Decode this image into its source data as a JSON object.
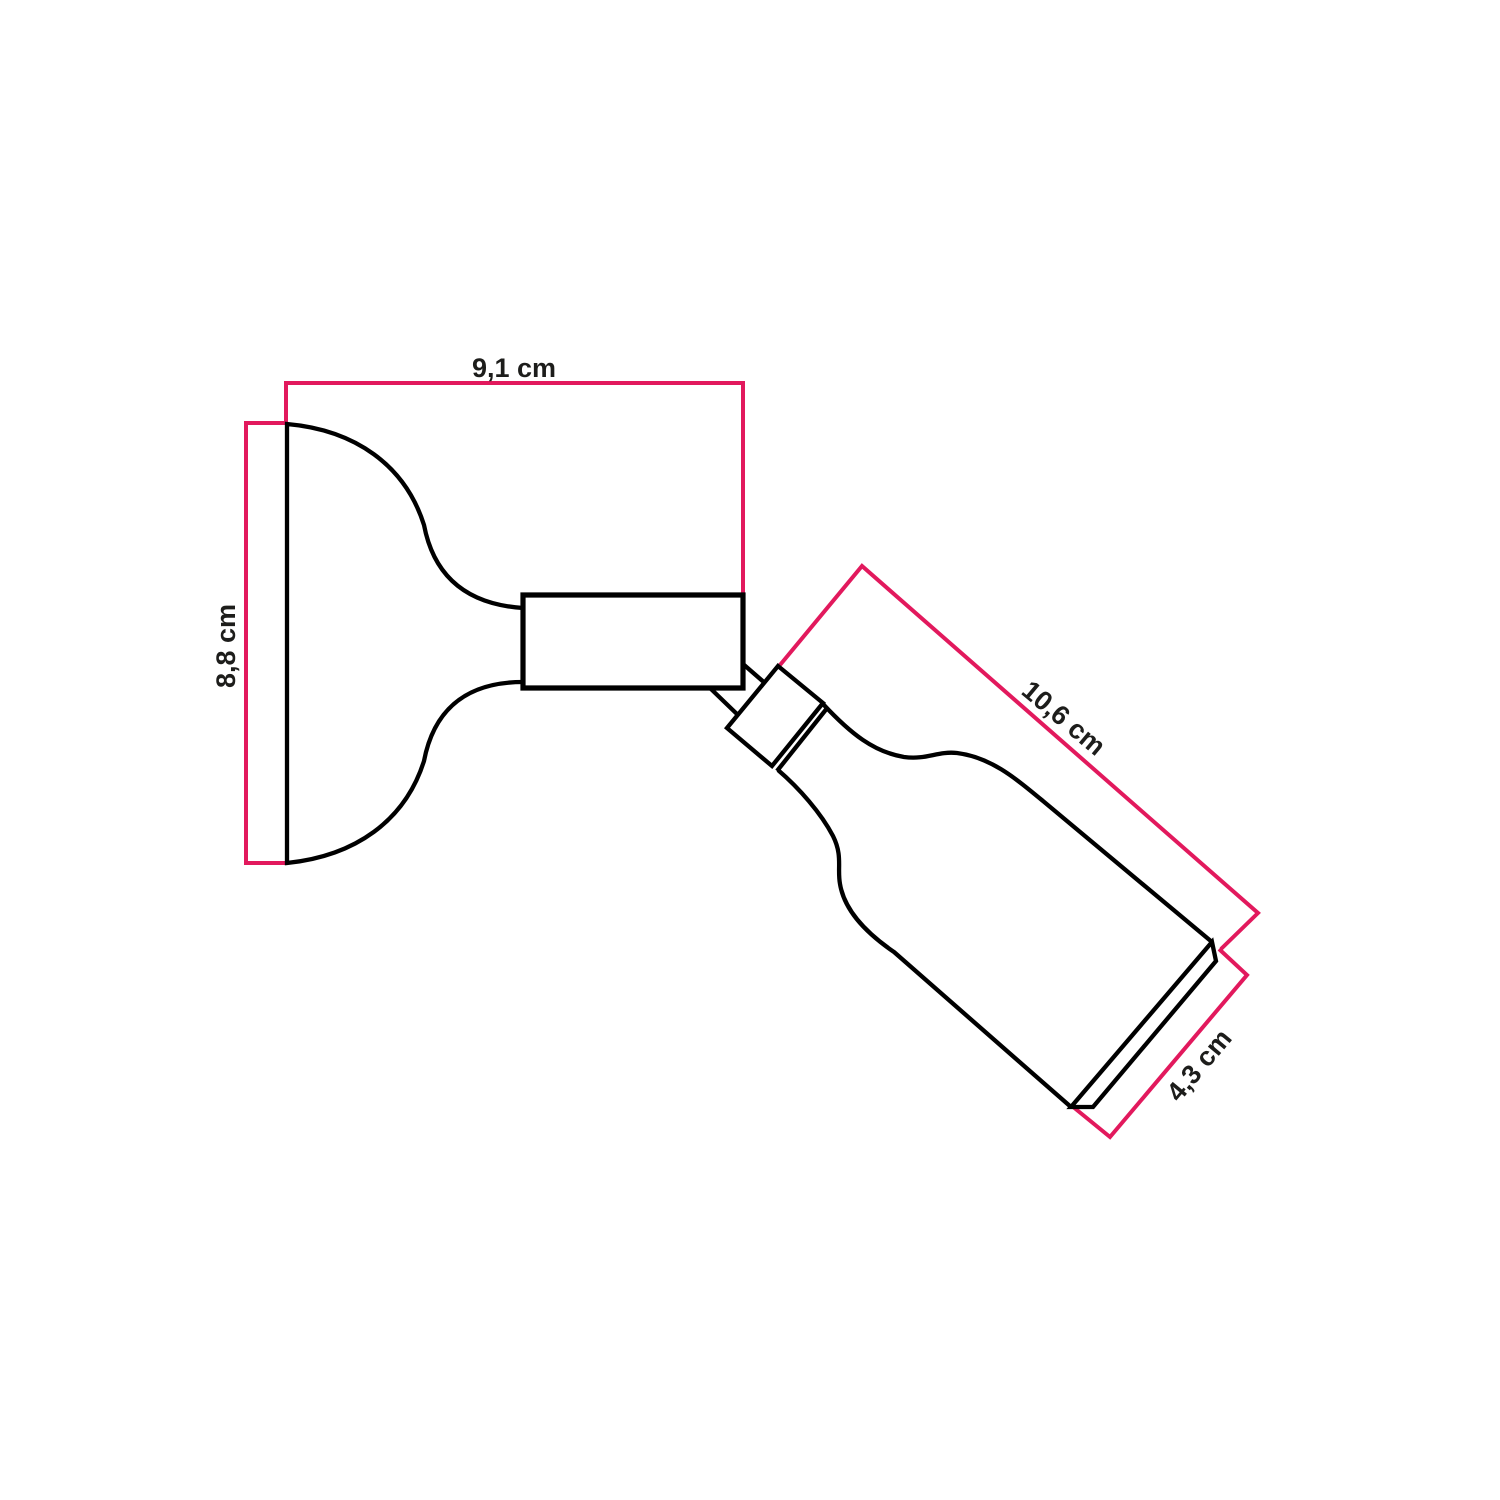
{
  "colors": {
    "background": "#ffffff",
    "outline": "#000000",
    "dimension_line": "#e2195d",
    "label_text": "#1d1d1b"
  },
  "dimensions": {
    "plate_width": {
      "label": "9,1 cm",
      "value_cm": 9.1,
      "unit": "cm"
    },
    "plate_height": {
      "label": "8,8 cm",
      "value_cm": 8.8,
      "unit": "cm"
    },
    "holder_length": {
      "label": "10,6 cm",
      "value_cm": 10.6,
      "unit": "cm"
    },
    "holder_opening": {
      "label": "4,3 cm",
      "value_cm": 4.3,
      "unit": "cm"
    }
  }
}
